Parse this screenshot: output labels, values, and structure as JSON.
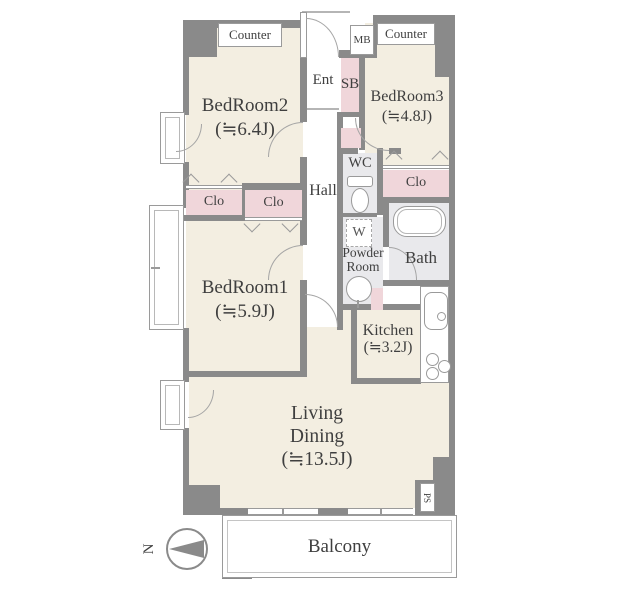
{
  "colors": {
    "wall": "#8a8a8a",
    "floor": "#f3eee1",
    "closet_pink": "#f0d6da",
    "wet_gray": "#e9e9ec",
    "background": "#ffffff"
  },
  "rooms": {
    "bedroom2": {
      "name": "BedRoom2",
      "size": "(≒6.4J)"
    },
    "bedroom3": {
      "name": "BedRoom3",
      "size": "(≒4.8J)"
    },
    "bedroom1": {
      "name": "BedRoom1",
      "size": "(≒5.9J)"
    },
    "living_dining": {
      "line1": "Living",
      "line2": "Dining",
      "size": "(≒13.5J)"
    },
    "kitchen": {
      "name": "Kitchen",
      "size": "(≒3.2J)"
    },
    "bath": {
      "name": "Bath"
    },
    "wc": {
      "name": "WC"
    },
    "powder_room": {
      "line1": "Powder",
      "line2": "Room"
    },
    "hall": {
      "name": "Hall"
    },
    "entrance": {
      "name": "Ent"
    },
    "balcony": {
      "name": "Balcony"
    }
  },
  "labels": {
    "counter_left": "Counter",
    "counter_right": "Counter",
    "meter_box": "MB",
    "shoe_box": "SB",
    "closet_bedroom2": "Clo",
    "closet_bedroom1": "Clo",
    "closet_bedroom3": "Clo",
    "washer": "W",
    "pipe_space": "PS",
    "north": "N"
  }
}
